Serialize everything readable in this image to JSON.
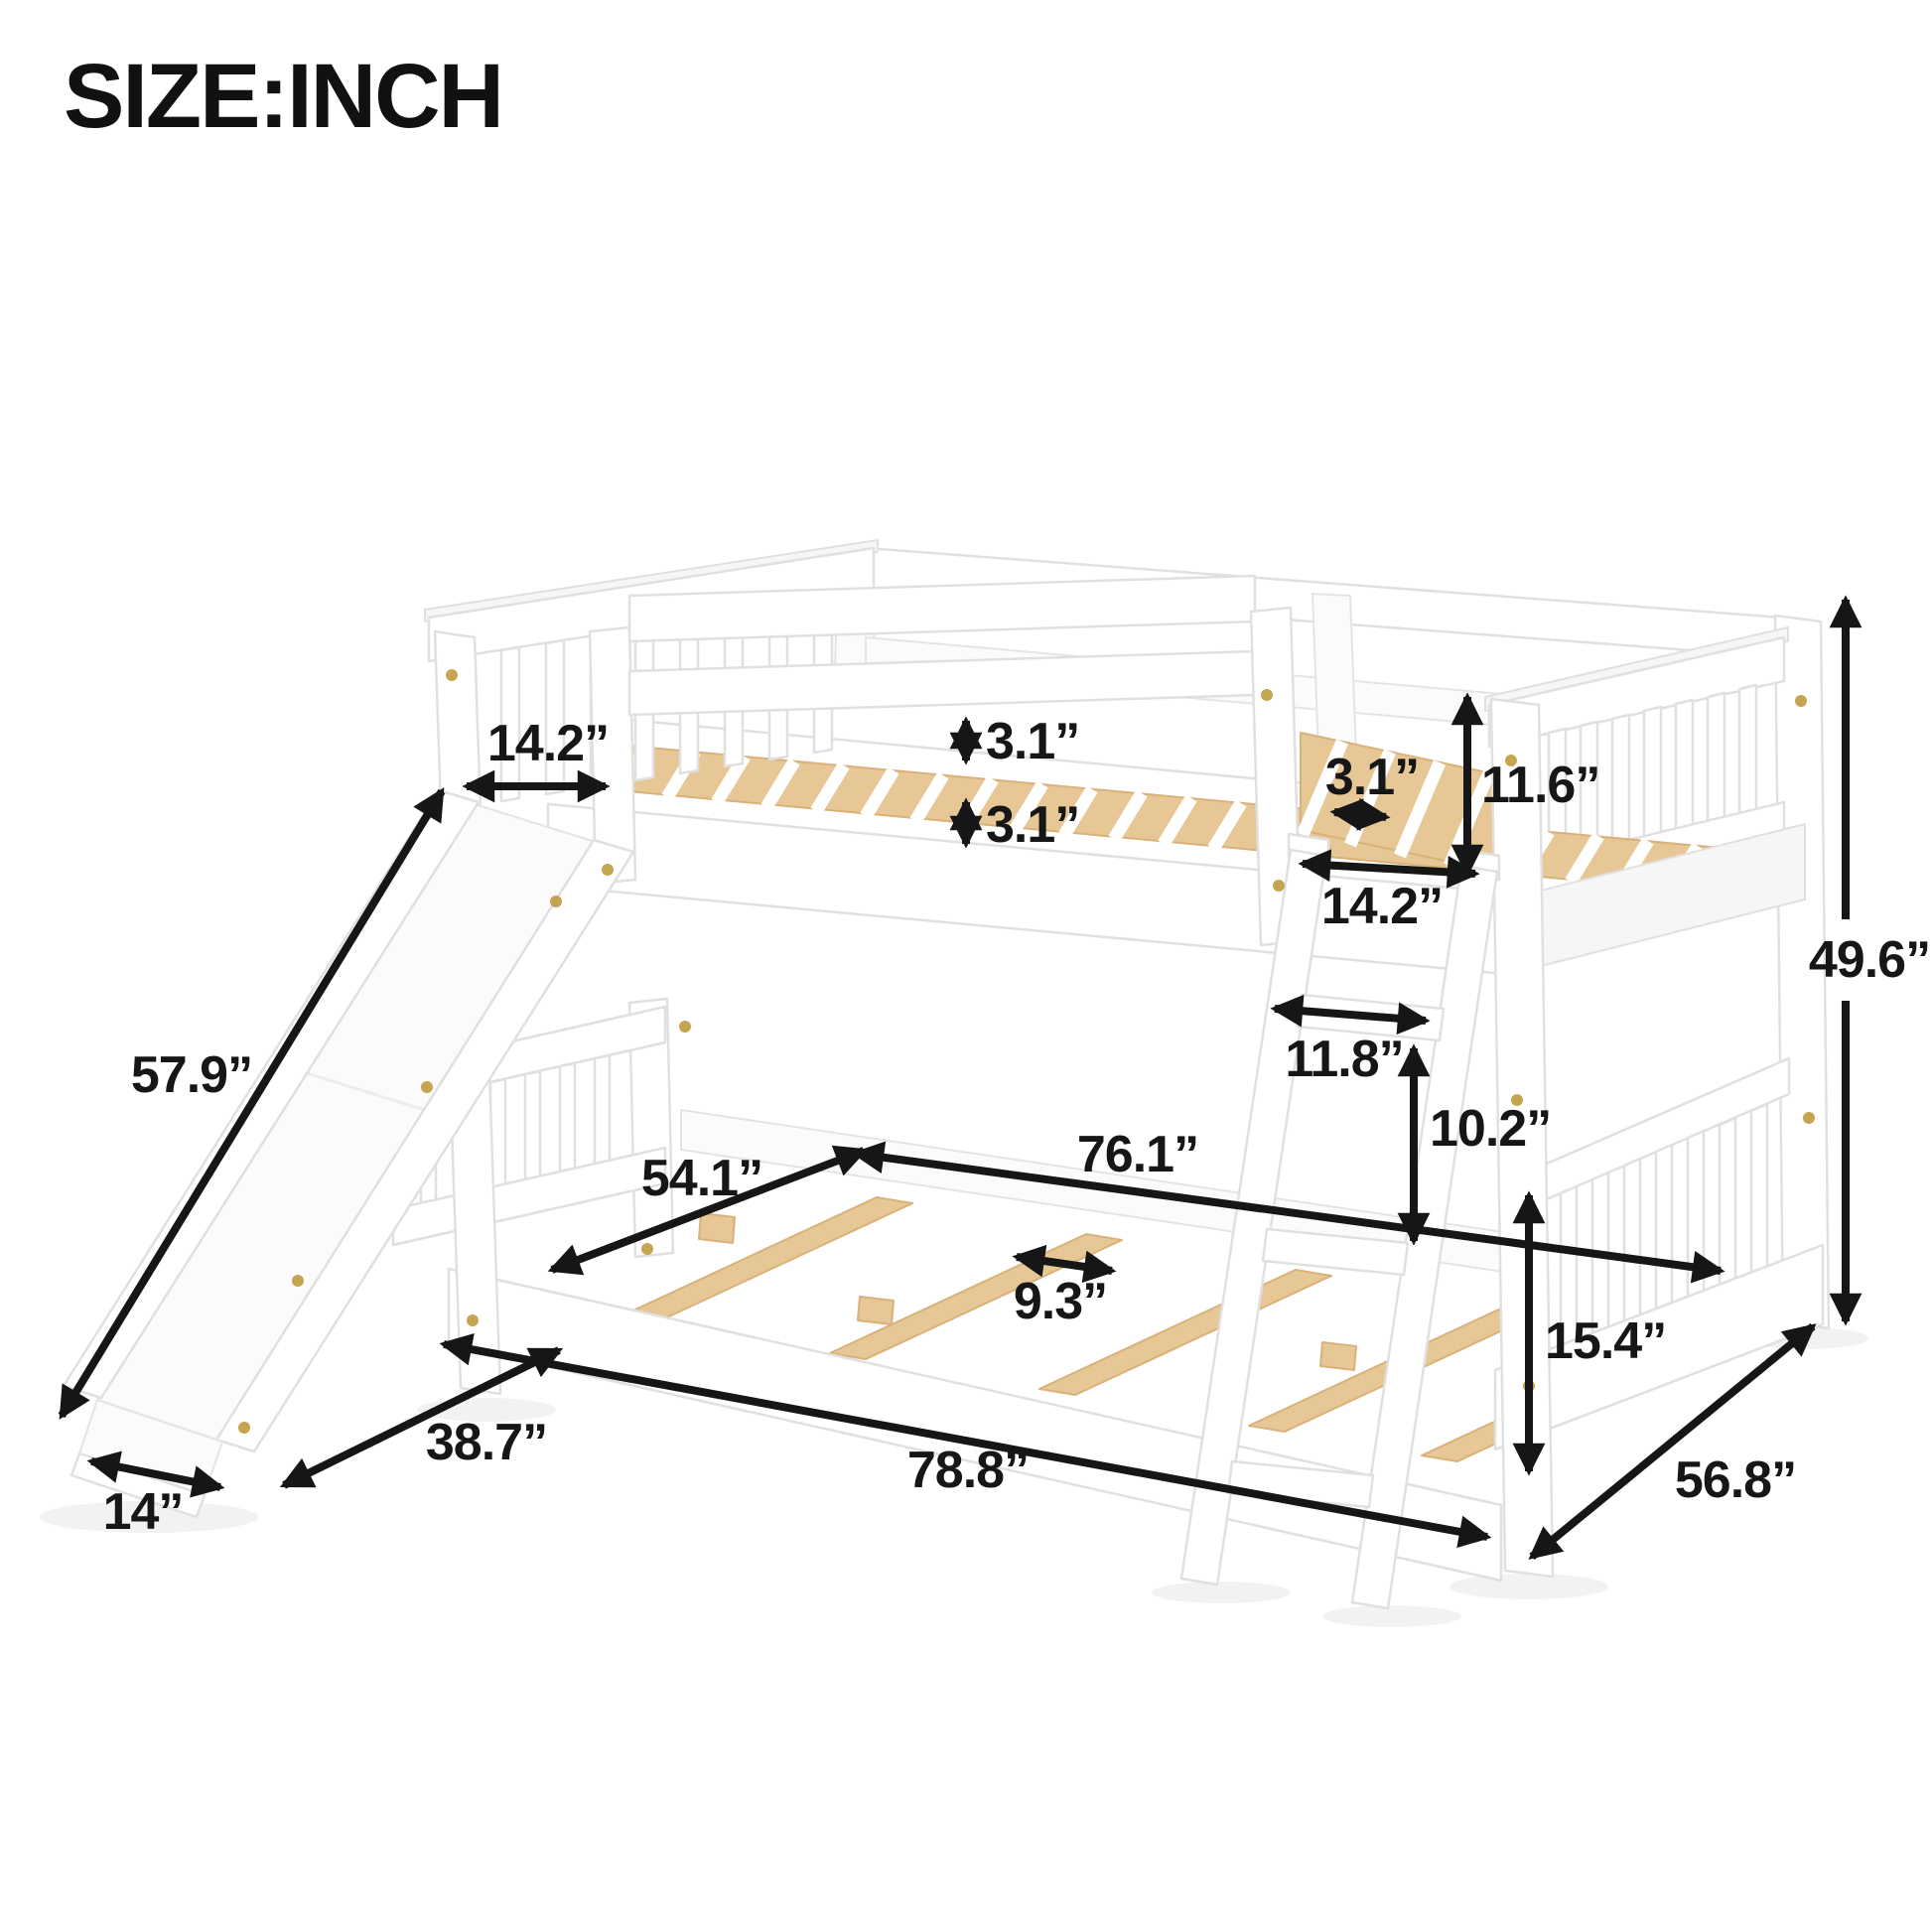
{
  "title": "SIZE:INCH",
  "figure": "full-over-full-bunk-bed-with-slide-and-ladder",
  "colors": {
    "background": "#ffffff",
    "frame_white": "#ffffff",
    "frame_outline": "#e0e0e0",
    "slat_wood": "#e7c795",
    "slat_wood_edge": "#d8b27a",
    "dimension_ink": "#161616",
    "screw_gold": "#bf9b3f"
  },
  "dimensions": {
    "slide_top_opening": "14.2”",
    "guard_gap_upper": "3.1”",
    "guard_gap_lower": "3.1”",
    "top_slat_spacing": "3.1”",
    "top_guard_height": "11.6”",
    "ladder_opening_width": "14.2”",
    "ladder_step_width": "11.8”",
    "ladder_rung_spacing": "10.2”",
    "overall_height": "49.6”",
    "slide_length": "57.9”",
    "bed_width": "54.1”",
    "inner_length": "76.1”",
    "bottom_slat_spacing": "9.3”",
    "bottom_rail_height": "15.4”",
    "slide_footprint": "38.7”",
    "overall_length": "78.8”",
    "slide_end_width": "14”",
    "overall_depth": "56.8”"
  }
}
